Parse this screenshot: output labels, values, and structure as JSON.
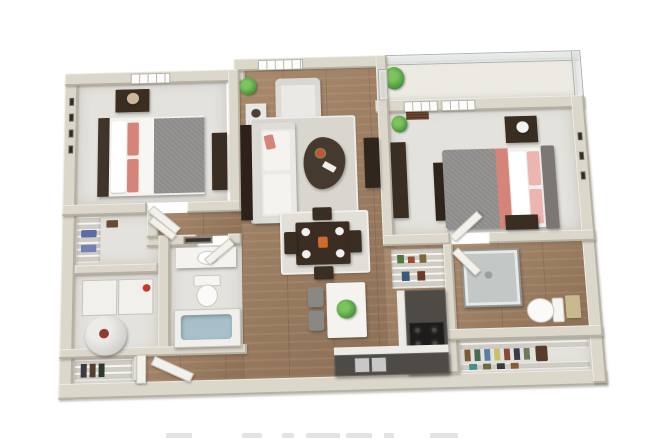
{
  "image": {
    "kind": "3d-floor-plan-render",
    "view": "top-down perspective, two-bedroom apartment, no visible text labels",
    "canvas": {
      "width": 650,
      "height": 440,
      "background": "#ffffff"
    },
    "cropped_caption": {
      "present": true,
      "legible": false,
      "position": "bottom edge, partially cut off"
    }
  },
  "palette": {
    "wall": "#dcd7cb",
    "wall_shade": "#b7b1a2",
    "floor_wood": "#a98a6d",
    "floor_wood_dark": "#8c6f55",
    "floor_carpet": "#e4e2dd",
    "rug": "#d9d6d0",
    "sofa": "#ebe9e6",
    "accent_coral": "#d5847a",
    "accent_pink": "#ecb5af",
    "bedding_gray": "#8d8c8a",
    "furniture_dark": "#3a2d22",
    "counter_dark": "#4e4a45",
    "counter_edge": "#edebe6",
    "island_white": "#f4f3f0",
    "plant_green": "#55a044",
    "water_blue": "#a7c0ca",
    "glass_gray": "#ccd2d0",
    "appliance_white": "#f1f0ed",
    "stove_black": "#1d1c1a",
    "door_white": "#f3f1eb",
    "towel_blue": "#5a6da8"
  },
  "scene": {
    "rooms": [
      {
        "name": "bedroom-1",
        "position": "top-left",
        "floor": "carpet",
        "furniture": [
          "bed-gray-coral",
          "headboard-dark",
          "nightstand-lamp",
          "dresser",
          "four-wall-frames",
          "window"
        ]
      },
      {
        "name": "living-room",
        "position": "top-center",
        "floor": "wood",
        "furniture": [
          "sofa-white",
          "armchair",
          "side-table-lamp",
          "coffee-table-dark",
          "area-rug",
          "media-console",
          "plants",
          "window"
        ]
      },
      {
        "name": "dining-area",
        "position": "center",
        "floor": "wood",
        "furniture": [
          "dining-table-dark",
          "four-chairs",
          "place-settings",
          "rug"
        ]
      },
      {
        "name": "balcony",
        "position": "top-right",
        "floor": "light",
        "furniture": [
          "glass-railing",
          "potted-plant"
        ]
      },
      {
        "name": "bedroom-2",
        "position": "right",
        "floor": "carpet",
        "furniture": [
          "bed-gray-coral-pink",
          "upholstered-headboard",
          "nightstands",
          "lamp",
          "dresser",
          "three-wall-frames",
          "two-windows",
          "plant"
        ]
      },
      {
        "name": "linen-closet",
        "position": "left-middle",
        "floor": "carpet",
        "furniture": [
          "wire-shelving",
          "blue-towels"
        ]
      },
      {
        "name": "laundry-utility",
        "position": "left",
        "floor": "carpet",
        "furniture": [
          "washer",
          "dryer",
          "water-heater"
        ]
      },
      {
        "name": "bathroom-1",
        "position": "center-left",
        "floor": "carpet",
        "furniture": [
          "vanity-sink",
          "mirror",
          "toilet",
          "bathtub"
        ]
      },
      {
        "name": "kitchen",
        "position": "center-right",
        "floor": "wood",
        "furniture": [
          "l-shaped-counter",
          "stove",
          "double-sink",
          "island-white",
          "two-stools",
          "plant",
          "pantry-wire-shelves"
        ]
      },
      {
        "name": "bathroom-2",
        "position": "right-lower",
        "floor": "wood",
        "furniture": [
          "glass-shower",
          "toilet",
          "towels"
        ]
      },
      {
        "name": "walk-in-closet",
        "position": "bottom-right",
        "floor": "carpet",
        "furniture": [
          "wire-shelving",
          "hanging-clothes",
          "shoes"
        ]
      },
      {
        "name": "entry",
        "position": "bottom-left",
        "floor": "wood",
        "furniture": [
          "entry-door-open",
          "coat-closet-wire-shelves"
        ]
      }
    ]
  }
}
